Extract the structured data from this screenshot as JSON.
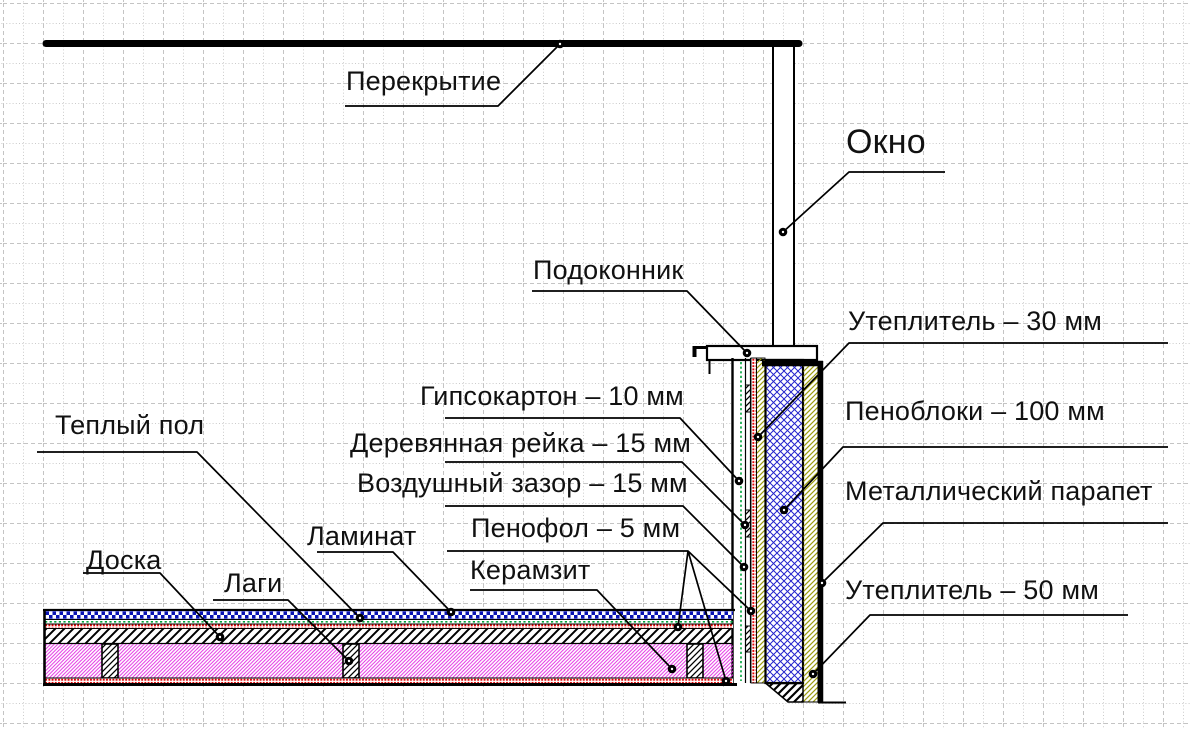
{
  "diagram": {
    "type": "construction-cross-section",
    "labels": [
      {
        "id": "perekrytie",
        "text": "Перекрытие"
      },
      {
        "id": "okno",
        "text": "Окно"
      },
      {
        "id": "podokonnik",
        "text": "Подоконник"
      },
      {
        "id": "ut30",
        "text": "Утеплитель – 30 мм"
      },
      {
        "id": "penobloki",
        "text": "Пеноблоки – 100 мм"
      },
      {
        "id": "parapet",
        "text": "Металлический парапет"
      },
      {
        "id": "ut50",
        "text": "Утеплитель – 50 мм"
      },
      {
        "id": "gipsokarton",
        "text": "Гипсокартон – 10 мм"
      },
      {
        "id": "reika",
        "text": "Деревянная рейка – 15 мм"
      },
      {
        "id": "zazor",
        "text": "Воздушный зазор – 15 мм"
      },
      {
        "id": "penofol",
        "text": "Пенофол – 5 мм"
      },
      {
        "id": "keramzit",
        "text": "Керамзит"
      },
      {
        "id": "teply_pol",
        "text": "Теплый пол"
      },
      {
        "id": "laminat",
        "text": "Ламинат"
      },
      {
        "id": "doska",
        "text": "Доска"
      },
      {
        "id": "lagi",
        "text": "Лаги"
      }
    ],
    "colors": {
      "line": "#000000",
      "grid_dash": "#c4c4c4",
      "grid_dot": "#cbcbcb",
      "penofol_red": "#e00000",
      "teply_pol_green": "#00a33c",
      "penobloki_blue": "#2424cc",
      "laminat_blue": "#0a14b4",
      "uteplitel_olive": "#9c9c10",
      "keramzit_magenta": "#e32ce3"
    }
  }
}
